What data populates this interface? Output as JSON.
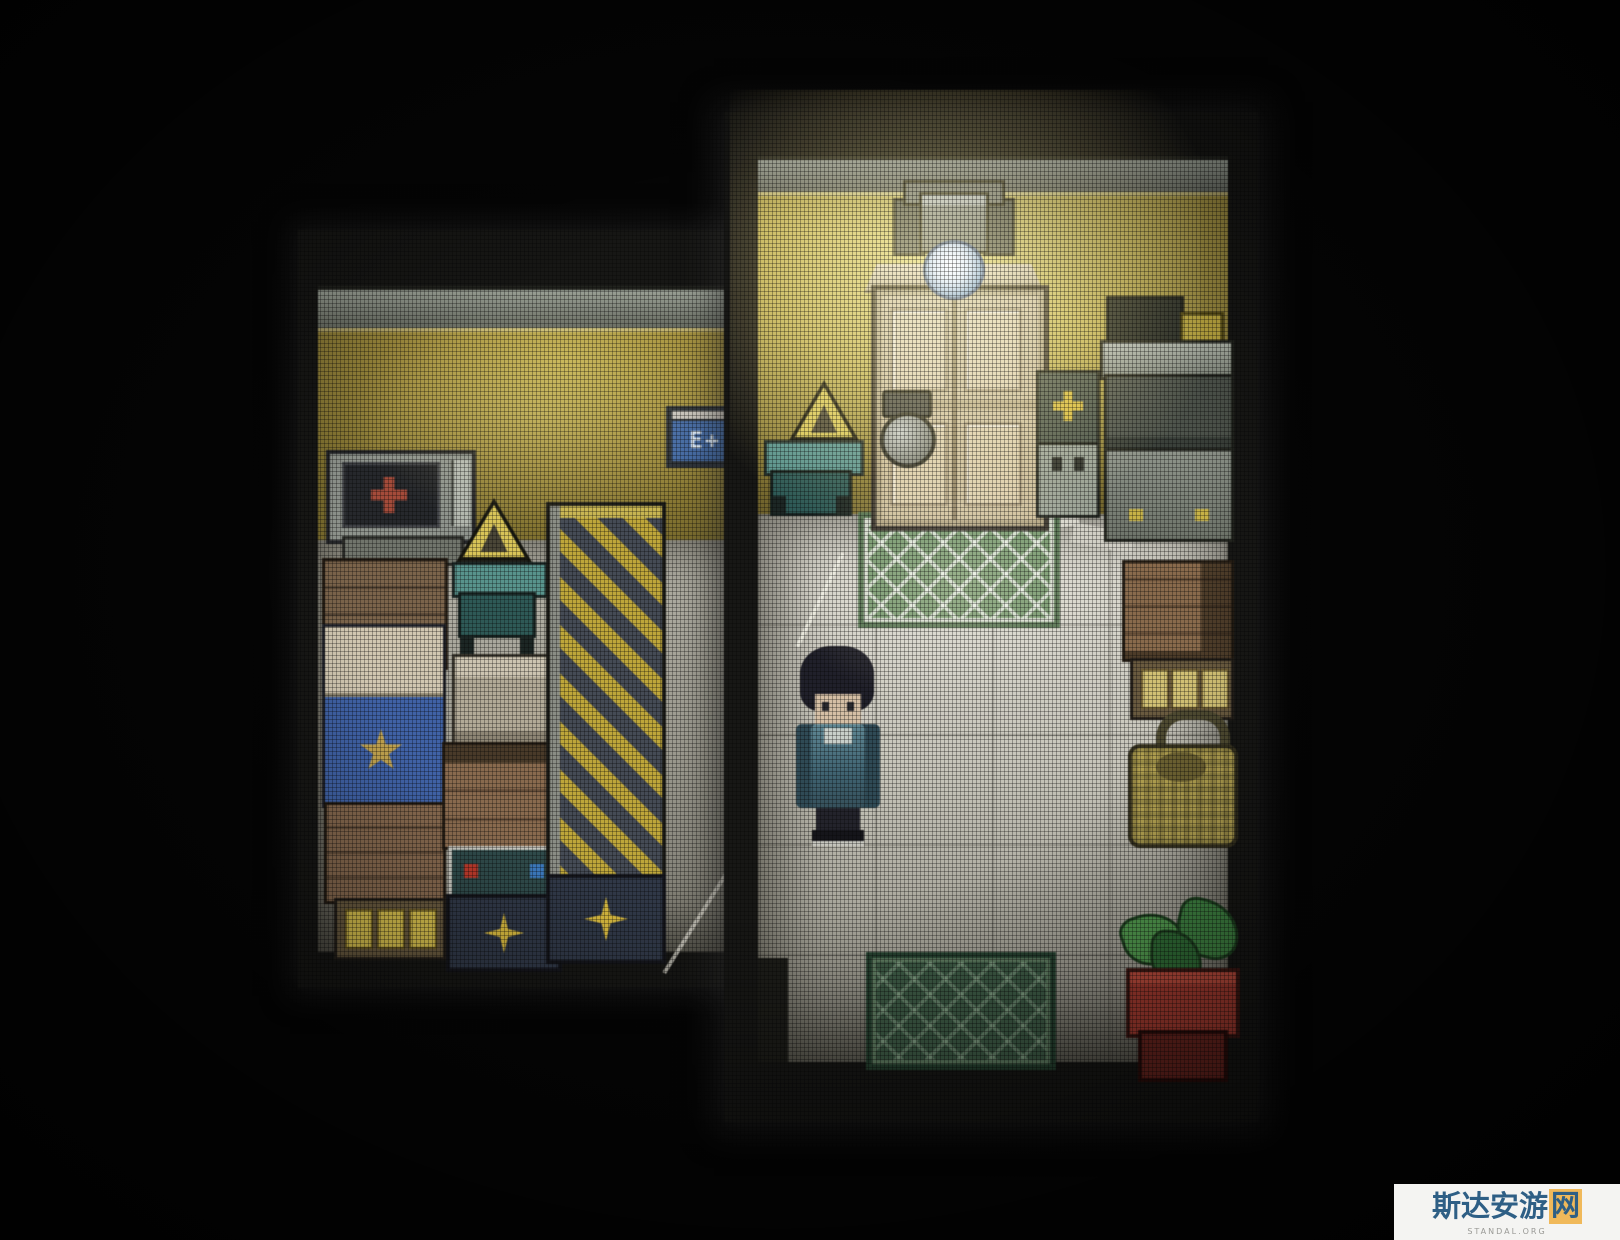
{
  "scene": {
    "description": "Top-down pixel-art RPG interior with CRT screen effect, two rooms lit by a ceiling lamp",
    "sign_text": "E+",
    "rooms": [
      {
        "name": "left-room",
        "wall_color": "#a6953c",
        "objects": [
          "crt-tv-red-cross",
          "warning-triangle-sign",
          "teal-desk",
          "bed-blue-blanket-star",
          "wooden-crates",
          "book-shelf",
          "red-blue-button-machine",
          "spark-panel",
          "hazard-striped-door",
          "e-plus-wall-sign"
        ]
      },
      {
        "name": "right-room",
        "wall_color": "#c9b44e",
        "floor_color": "#d6d4ca",
        "objects": [
          "ceiling-lamp",
          "wooden-door",
          "warning-triangle-sign",
          "teal-desk",
          "door-porthole",
          "plus-machine",
          "dresser",
          "green-rug-top",
          "green-rug-bottom",
          "wooden-crate",
          "storage-shelf",
          "woven-basket",
          "potted-plant",
          "player-character",
          "floor-papers",
          "floor-crack"
        ]
      }
    ],
    "player": {
      "facing": "down",
      "hair_color": "#20202a",
      "jacket_color": "#3f6574",
      "skin_color": "#d6bfa4"
    }
  },
  "colors": {
    "background": "#050505",
    "hazard_yellow": "#bfa634",
    "hazard_dark": "#454b56",
    "rug_green": "#6f9468",
    "rug_dark_green": "#3c5a44",
    "door_wood": "#cdbc96",
    "pot_red": "#a83a2e",
    "leaf_green": "#4f9c4c",
    "spark_yellow": "#d8b838",
    "lamp_bulb_blue": "#3868a8"
  },
  "watermark": {
    "site_name": "斯达安游网",
    "site_name_prefix": "斯达安游",
    "site_name_suffix": "网",
    "site_sub": "STANDAL.ORG",
    "text_color": "#2e5f85",
    "accent_color": "#f0b95a",
    "background": "#f4f4f2"
  }
}
